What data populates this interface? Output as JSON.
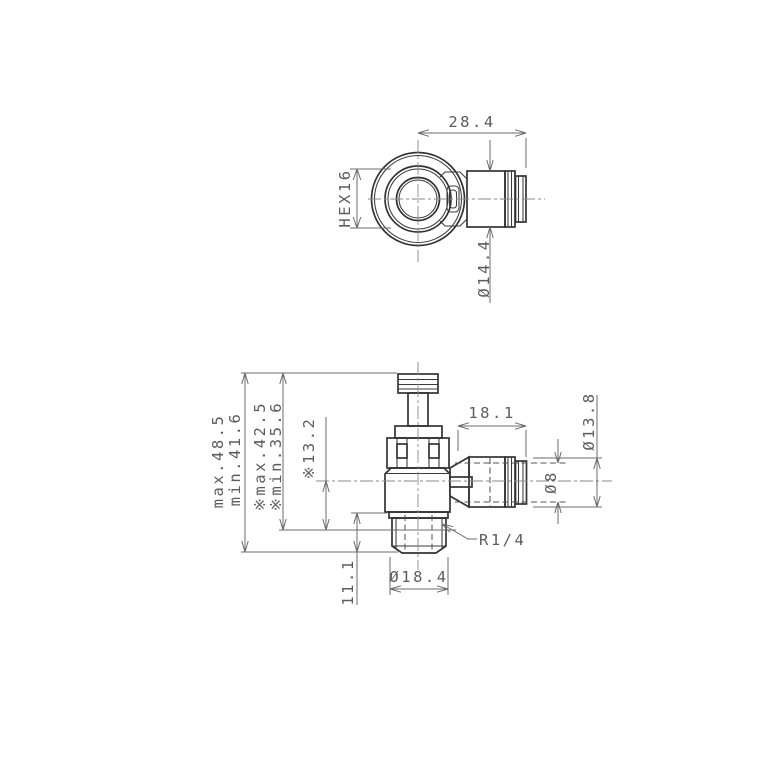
{
  "drawing": {
    "views": {
      "top": {
        "dims": {
          "width": "28.4",
          "hex": "HEX16",
          "diameter": "Ø14.4"
        }
      },
      "front": {
        "dims": {
          "overall_max": "max.48.5",
          "overall_min": "min.41.6",
          "installed_max": "※max.42.5",
          "installed_min": "※min.35.6",
          "center_height": "※13.2",
          "thread_length": "11.1",
          "thread_od": "Ø18.4",
          "thread_spec": "R1/4",
          "fitting_length": "18.1",
          "tube_bore": "Ø8",
          "fitting_od": "Ø13.8"
        }
      }
    },
    "colors": {
      "line": "#333333",
      "dimension": "#6b6b6b",
      "background": "#ffffff"
    }
  }
}
